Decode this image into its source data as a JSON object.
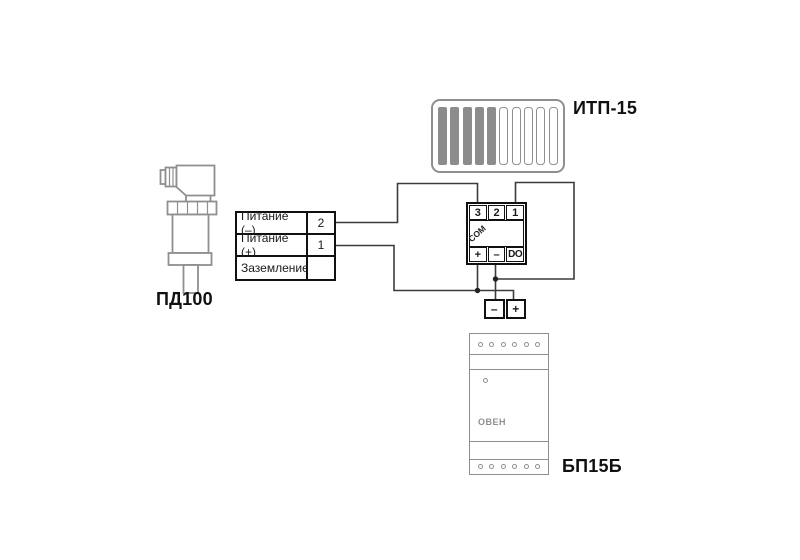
{
  "diagram": {
    "background_color": "#ffffff",
    "wire_color": "#3c3c3c",
    "device_outline_color": "#8f8f8f",
    "block_border_color": "#111111",
    "bar_fill_color": "#8c8c8c"
  },
  "pd100": {
    "label": "ПД100",
    "table": {
      "rows": [
        {
          "label": "Питание (–)",
          "terminal": "2"
        },
        {
          "label": "Питание (+)",
          "terminal": "1"
        },
        {
          "label": "Заземление",
          "terminal": ""
        }
      ]
    }
  },
  "itp15": {
    "label": "ИТП-15",
    "display": {
      "segments_total": 10,
      "segments_filled": 5
    },
    "terminal_block": {
      "top": [
        "3",
        "2",
        "1"
      ],
      "middle": "COM",
      "bottom": [
        "+",
        "–",
        "DO"
      ]
    }
  },
  "power_output_block": {
    "terminals": [
      "–",
      "+"
    ]
  },
  "bp15b": {
    "label": "БП15Б",
    "logo": "ОВЕН",
    "terminal_dots_per_row": 6
  }
}
